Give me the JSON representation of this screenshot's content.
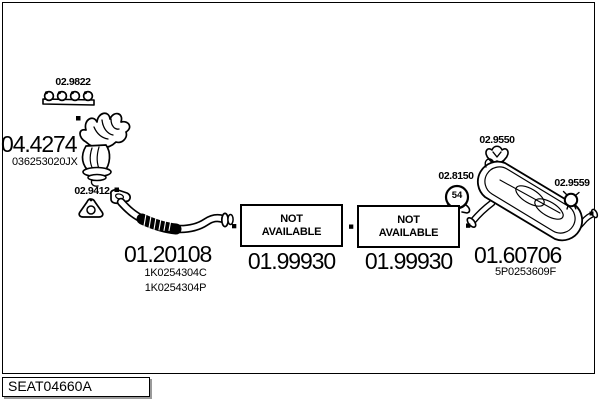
{
  "frame": {
    "drawing_code": "SEAT04660A"
  },
  "parts": {
    "manifold_gasket": {
      "code": "02.9822"
    },
    "catalytic_converter": {
      "code": "04.4274",
      "oem": "036253020JX"
    },
    "front_pipe_gasket": {
      "code": "02.9412"
    },
    "front_pipe": {
      "code": "01.20108",
      "oem_1": "1K0254304C",
      "oem_2": "1K0254304P"
    },
    "centre_silencer_left": {
      "code": "01.99930",
      "availability": "NOT AVAILABLE"
    },
    "centre_silencer_right": {
      "code": "01.99930",
      "availability": "NOT AVAILABLE"
    },
    "clamp": {
      "code": "02.8150",
      "diameter": "54"
    },
    "rubber_mounting": {
      "code": "02.9550"
    },
    "rear_silencer": {
      "code": "01.60706",
      "oem": "5P0253609F"
    },
    "tailpipe_clamp": {
      "code": "02.9559"
    }
  },
  "colors": {
    "ink": "#000000",
    "paper": "#ffffff",
    "shadow": "#9a9a9a"
  }
}
